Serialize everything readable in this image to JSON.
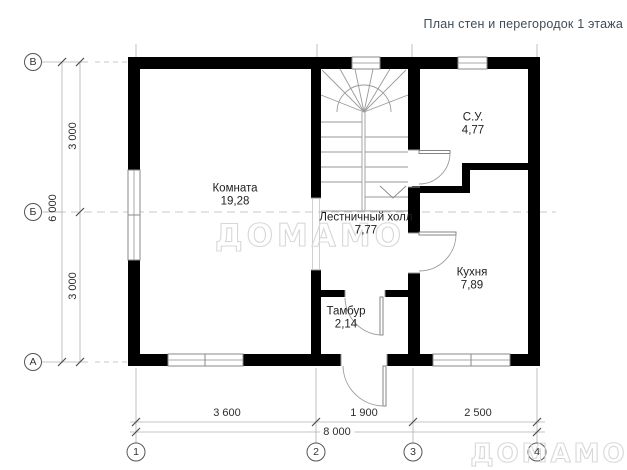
{
  "title": "План стен и перегородок 1 этажа",
  "watermark": "ДОМАМО",
  "rooms": [
    {
      "name": "Комната",
      "area": "19,28"
    },
    {
      "name": "Лестничный холл",
      "area": "7,77"
    },
    {
      "name": "С.У.",
      "area": "4,77"
    },
    {
      "name": "Кухня",
      "area": "7,89"
    },
    {
      "name": "Тамбур",
      "area": "2,14"
    }
  ],
  "axes": {
    "rows": [
      "В",
      "Б",
      "А"
    ],
    "columns": [
      "1",
      "2",
      "3",
      "4"
    ]
  },
  "dimensions": {
    "left_spans": [
      "3 000",
      "3 000"
    ],
    "left_total": "6 000",
    "bottom_spans": [
      "3 600",
      "1 900",
      "2 500"
    ],
    "bottom_total": "8 000"
  },
  "colors": {
    "wall": "#000000",
    "drawing_line": "#9a9a9a",
    "title_text": "#3f4d57",
    "watermark_outline": "#d8d8d8"
  }
}
